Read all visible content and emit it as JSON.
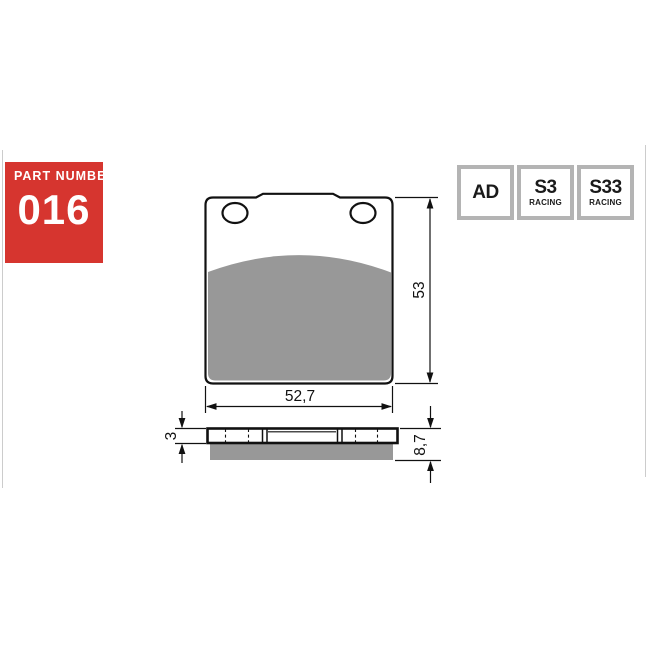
{
  "part_number_box": {
    "label": "PART NUMBER",
    "number": "016"
  },
  "compound_badges": [
    {
      "code": "AD",
      "sub": ""
    },
    {
      "code": "S3",
      "sub": "RACING"
    },
    {
      "code": "S33",
      "sub": "RACING"
    }
  ],
  "diagram": {
    "front_view": {
      "width_label": "52,7",
      "height_label": "53"
    },
    "side_view": {
      "backplate_thickness_label": "3",
      "total_thickness_label": "8,7"
    }
  },
  "colors": {
    "accent_red": "#d6352f",
    "friction_gray": "#989898",
    "badge_border_gray": "#b4b4b4",
    "line_color": "#111111"
  }
}
